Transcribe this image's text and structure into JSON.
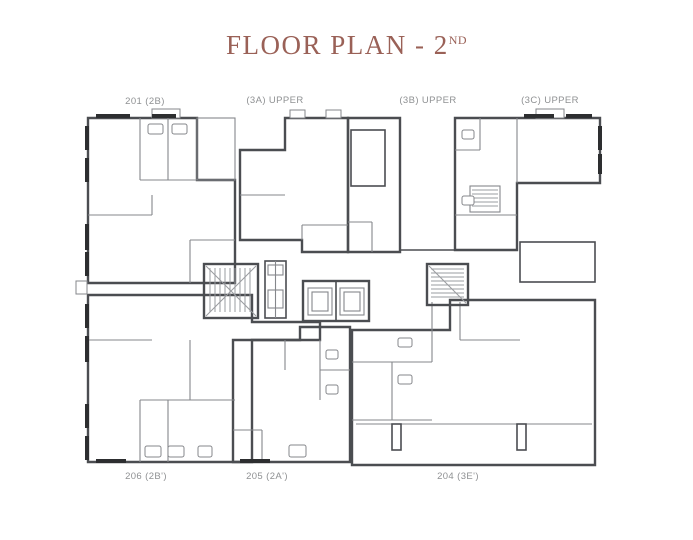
{
  "page": {
    "background": "#ffffff"
  },
  "title": {
    "text": "FLOOR PLAN - 2",
    "superscript": "ND",
    "color": "#9a6157"
  },
  "colors": {
    "label_text": "#8f9193",
    "walls": "#4b4d51",
    "background": "#ffffff"
  },
  "units": [
    {
      "id": "201",
      "label": "201 (2B)",
      "color": "#d2d3d5",
      "position": "top-left"
    },
    {
      "id": "3A",
      "label": "(3A) UPPER",
      "color": "#e1e4e7",
      "position": "top-center-left"
    },
    {
      "id": "3B",
      "label": "(3B) UPPER",
      "color": "#9b9ea3",
      "position": "top-center-right"
    },
    {
      "id": "3C",
      "label": "(3C) UPPER",
      "color": "#c2a79e",
      "position": "top-right"
    },
    {
      "id": "206",
      "label": "206 (2B')",
      "color": "#d2d3d5",
      "position": "bottom-left"
    },
    {
      "id": "205",
      "label": "205 (2A')",
      "color": "#cdd7dc",
      "position": "bottom-center"
    },
    {
      "id": "204",
      "label": "204 (3E')",
      "color": "#ded3c1",
      "position": "bottom-right"
    }
  ]
}
